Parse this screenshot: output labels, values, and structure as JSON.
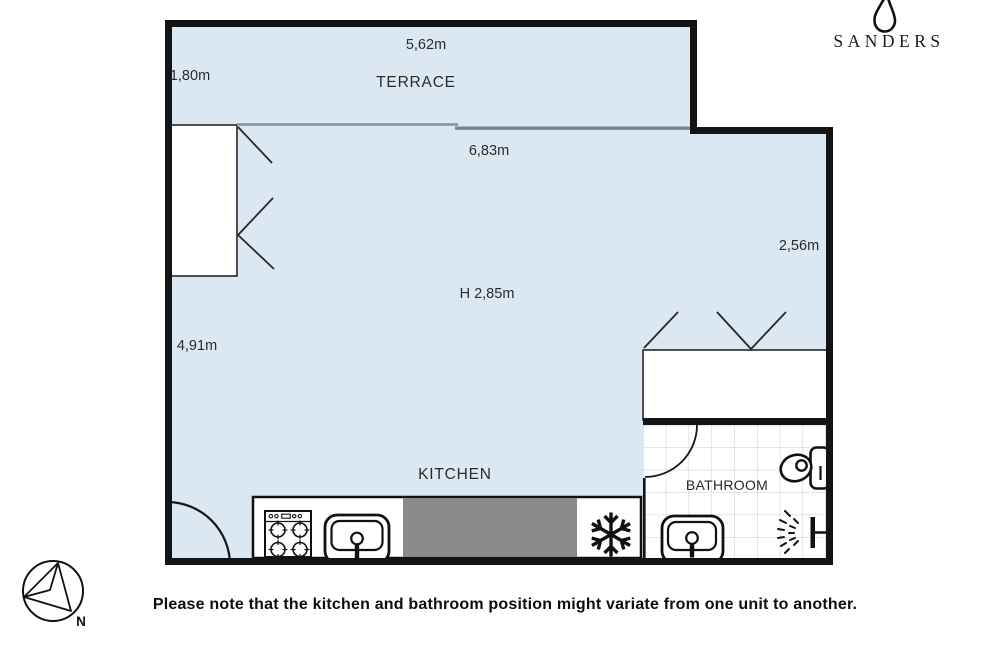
{
  "brand": {
    "name": "SANDERS",
    "logo_icon": "droplet-icon"
  },
  "plan": {
    "room_labels": {
      "terrace": "TERRACE",
      "kitchen": "KITCHEN",
      "bathroom": "BATHROOM"
    },
    "measurements": {
      "terrace_width": "5,62m",
      "terrace_depth": "1,80m",
      "living_width": "6,83m",
      "right_wall_depth": "2,56m",
      "ceiling_height": "H 2,85m",
      "living_depth": "4,91m"
    },
    "fixtures": [
      "stove",
      "kitchen-sink",
      "refrigerator",
      "bathroom-sink",
      "toilet",
      "shower",
      "wardrobe-left",
      "wardrobe-right"
    ]
  },
  "compass": {
    "north_label": "N"
  },
  "footer": {
    "note": "Please note that the kitchen and bathroom position might variate from one unit to another."
  },
  "colors": {
    "room_fill": "#dbe7f1",
    "wall": "#141414",
    "counter_gray": "#8a8a8a",
    "tile_line": "#c7cbd0",
    "thin_line": "#26262b"
  }
}
